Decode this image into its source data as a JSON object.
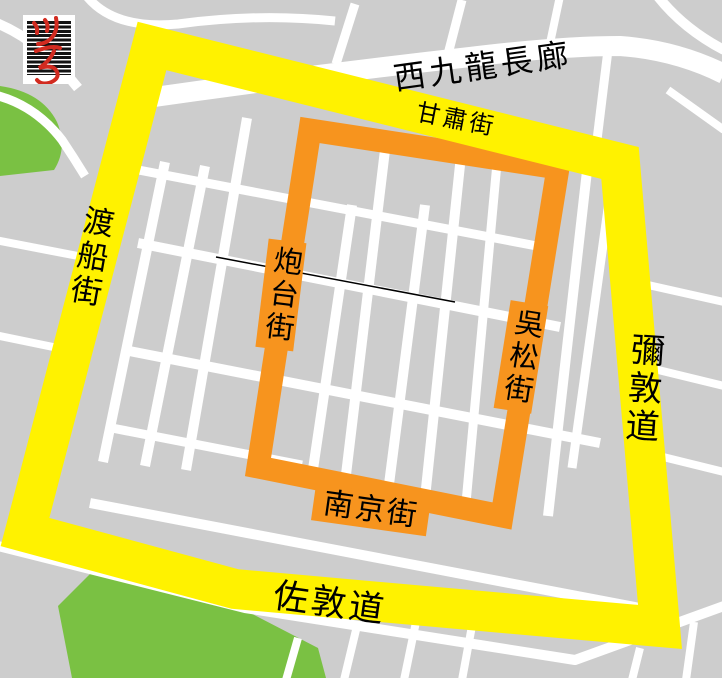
{
  "labels": {
    "promenade": "西九龍長廊",
    "gansu_street": "甘肅街",
    "ferry_street": "渡船街",
    "nathan_road": "彌敦道",
    "jordan_road": "佐敦道",
    "battery_street": "炮台街",
    "woosung_street": "吳松街",
    "nanking_street": "南京街"
  },
  "colors": {
    "background": "#CDCDCD",
    "road": "#FFFFFF",
    "outer_route": "#FFF200",
    "inner_route": "#F7941E",
    "park": "#7AC143",
    "label_text": "#000000",
    "boundary_line": "#000000",
    "logo_red": "#D22B20",
    "logo_stripe_bg": "#141414"
  },
  "icons": {
    "logo": "calligraphy-stamp-icon"
  }
}
